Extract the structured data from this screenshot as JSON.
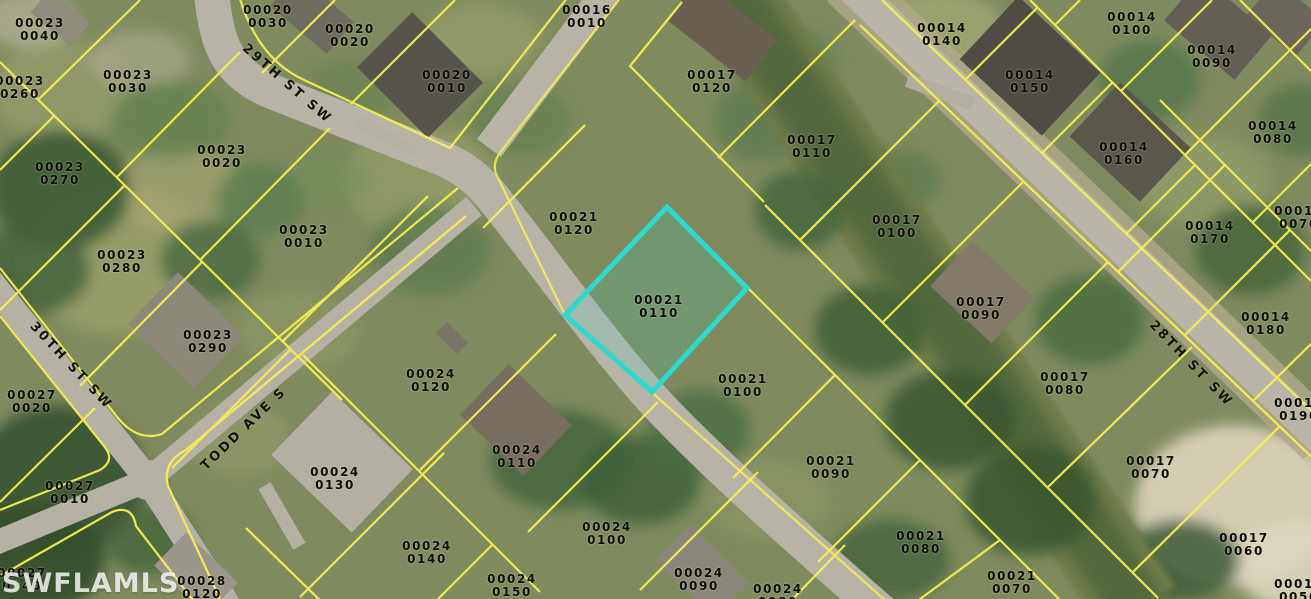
{
  "map": {
    "watermark": "SWFLAMLS",
    "highlighted_parcel_id": "00021 0110",
    "colors": {
      "parcel_line": "#f6ef52",
      "highlight": "#2fd8cd",
      "road": "#b7b4a7",
      "label_text": "#0c0c04"
    },
    "street_labels": [
      {
        "name": "29TH ST SW",
        "x": 287,
        "y": 84,
        "angle": 41
      },
      {
        "name": "30TH ST SW",
        "x": 71,
        "y": 366,
        "angle": 47
      },
      {
        "name": "TODD AVE S",
        "x": 244,
        "y": 429,
        "angle": -44
      },
      {
        "name": "28TH ST SW",
        "x": 1191,
        "y": 364,
        "angle": 46
      }
    ],
    "parcel_labels": [
      {
        "block": "00023",
        "lot": "0040",
        "x": 40,
        "y": 30
      },
      {
        "block": "00020",
        "lot": "0030",
        "x": 268,
        "y": 17
      },
      {
        "block": "00020",
        "lot": "0020",
        "x": 350,
        "y": 36
      },
      {
        "block": "00016",
        "lot": "0010",
        "x": 587,
        "y": 17
      },
      {
        "block": "00014",
        "lot": "0100",
        "x": 1132,
        "y": 24
      },
      {
        "block": "00014",
        "lot": "0140",
        "x": 942,
        "y": 35
      },
      {
        "block": "00014",
        "lot": "0090",
        "x": 1212,
        "y": 57
      },
      {
        "block": "00023",
        "lot": "0030",
        "x": 128,
        "y": 82
      },
      {
        "block": "00023",
        "lot": "0260",
        "x": 20,
        "y": 88
      },
      {
        "block": "00020",
        "lot": "0010",
        "x": 447,
        "y": 82
      },
      {
        "block": "00017",
        "lot": "0120",
        "x": 712,
        "y": 82
      },
      {
        "block": "00014",
        "lot": "0150",
        "x": 1030,
        "y": 82
      },
      {
        "block": "00014",
        "lot": "0080",
        "x": 1273,
        "y": 133
      },
      {
        "block": "00017",
        "lot": "0110",
        "x": 812,
        "y": 147
      },
      {
        "block": "00014",
        "lot": "0160",
        "x": 1124,
        "y": 154
      },
      {
        "block": "00023",
        "lot": "0020",
        "x": 222,
        "y": 157
      },
      {
        "block": "00023",
        "lot": "0270",
        "x": 60,
        "y": 174
      },
      {
        "block": "00014",
        "lot": "0070",
        "x": 1299,
        "y": 218
      },
      {
        "block": "00017",
        "lot": "0100",
        "x": 897,
        "y": 227
      },
      {
        "block": "00014",
        "lot": "0170",
        "x": 1210,
        "y": 233
      },
      {
        "block": "00023",
        "lot": "0010",
        "x": 304,
        "y": 237
      },
      {
        "block": "00021",
        "lot": "0120",
        "x": 574,
        "y": 224
      },
      {
        "block": "00023",
        "lot": "0280",
        "x": 122,
        "y": 262
      },
      {
        "block": "00021",
        "lot": "0110",
        "x": 659,
        "y": 307
      },
      {
        "block": "00017",
        "lot": "0090",
        "x": 981,
        "y": 309
      },
      {
        "block": "00014",
        "lot": "0180",
        "x": 1266,
        "y": 324
      },
      {
        "block": "00023",
        "lot": "0290",
        "x": 208,
        "y": 342
      },
      {
        "block": "00024",
        "lot": "0120",
        "x": 431,
        "y": 381
      },
      {
        "block": "00021",
        "lot": "0100",
        "x": 743,
        "y": 386
      },
      {
        "block": "00017",
        "lot": "0080",
        "x": 1065,
        "y": 384
      },
      {
        "block": "00027",
        "lot": "0020",
        "x": 32,
        "y": 402
      },
      {
        "block": "00014",
        "lot": "0190",
        "x": 1299,
        "y": 410
      },
      {
        "block": "00024",
        "lot": "0110",
        "x": 517,
        "y": 457
      },
      {
        "block": "00021",
        "lot": "0090",
        "x": 831,
        "y": 468
      },
      {
        "block": "00017",
        "lot": "0070",
        "x": 1151,
        "y": 468
      },
      {
        "block": "00024",
        "lot": "0130",
        "x": 335,
        "y": 479
      },
      {
        "block": "00027",
        "lot": "0010",
        "x": 70,
        "y": 493
      },
      {
        "block": "00024",
        "lot": "0100",
        "x": 607,
        "y": 534
      },
      {
        "block": "00021",
        "lot": "0080",
        "x": 921,
        "y": 543
      },
      {
        "block": "00017",
        "lot": "0060",
        "x": 1244,
        "y": 545
      },
      {
        "block": "00024",
        "lot": "0140",
        "x": 427,
        "y": 553
      },
      {
        "block": "00027",
        "lot": "0240",
        "x": 22,
        "y": 580
      },
      {
        "block": "00024",
        "lot": "0090",
        "x": 699,
        "y": 580
      },
      {
        "block": "00021",
        "lot": "0070",
        "x": 1012,
        "y": 583
      },
      {
        "block": "00024",
        "lot": "0150",
        "x": 512,
        "y": 586
      },
      {
        "block": "00028",
        "lot": "0120",
        "x": 202,
        "y": 588
      },
      {
        "block": "00017",
        "lot": "0050",
        "x": 1299,
        "y": 591
      },
      {
        "block": "00024",
        "lot": "0080",
        "x": 778,
        "y": 596
      }
    ],
    "highlight_polygon": [
      [
        667,
        207
      ],
      [
        747,
        288
      ],
      [
        652,
        392
      ],
      [
        565,
        315
      ]
    ]
  }
}
